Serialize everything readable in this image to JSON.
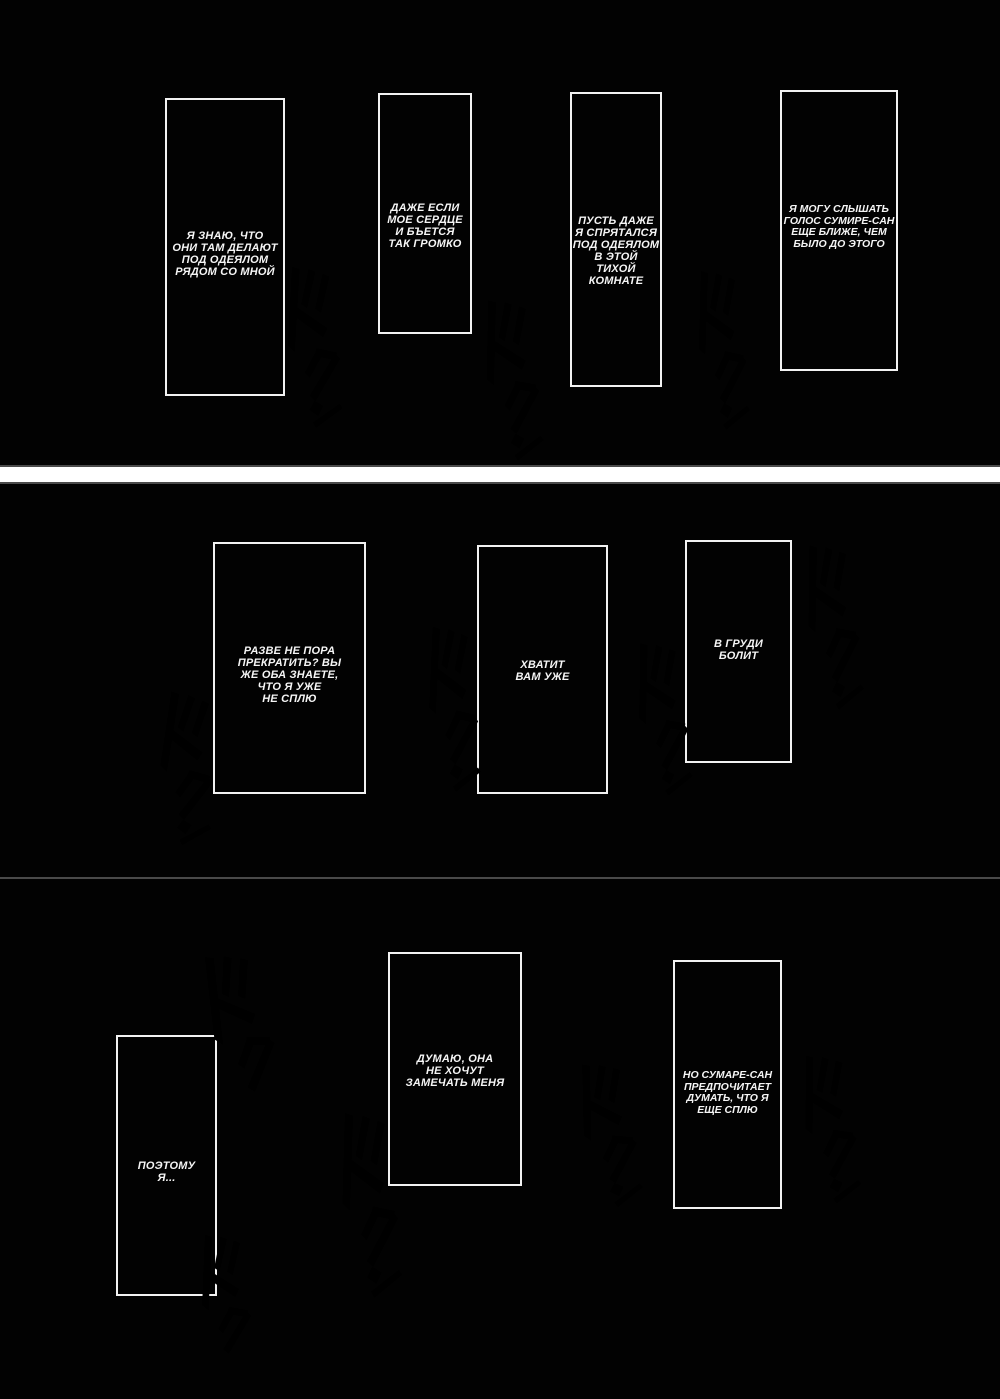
{
  "page": {
    "kind": "manga page (Russian translation)",
    "bg_color": "#ffffff",
    "strip_color": "#020202",
    "line_color": "#f2f2f2"
  },
  "strips": [
    {
      "panels": [
        {
          "text": "Я ЗНАЮ, ЧТО\nОНИ ТАМ ДЕЛАЮТ\nПОД ОДЕЯЛОМ\nРЯДОМ СО МНОЙ"
        },
        {
          "text": "ДАЖЕ ЕСЛИ\nМОЕ СЕРДЦЕ\nИ БЪЕТСЯ\nТАК ГРОМКО"
        },
        {
          "text": "ПУСТЬ ДАЖЕ\nЯ СПРЯТАЛСЯ\nПОД ОДЕЯЛОМ\nВ ЭТОЙ\nТИХОЙ\nКОМНАТЕ"
        },
        {
          "text": "Я МОГУ СЛЫШАТЬ\nГОЛОС СУМИРЕ-САН\nЕЩЕ БЛИЖЕ, ЧЕМ\nБЫЛО ДО ЭТОГО"
        }
      ]
    },
    {
      "panels": [
        {
          "text": "РАЗВЕ НЕ ПОРА\nПРЕКРАТИТЬ? ВЫ\nЖЕ ОБА ЗНАЕТЕ,\nЧТО Я УЖЕ\nНЕ СПЛЮ"
        },
        {
          "text": "ХВАТИТ\nВАМ УЖЕ"
        },
        {
          "text": "В ГРУДИ\nБОЛИТ"
        }
      ]
    },
    {
      "panels": [
        {
          "text": "ПОЭТОМУ\nЯ..."
        },
        {
          "text": "ДУМАЮ, ОНА\nНЕ ХОЧУТ\nЗАМЕЧАТЬ МЕНЯ"
        },
        {
          "text": "НО СУМАРЕ-САН\nПРЕДПОЧИТАЕТ\nДУМАТЬ, ЧТО Я\nЕЩЕ СПЛЮ"
        }
      ]
    }
  ],
  "sfx": {
    "glyphs": "ドクン",
    "name": "dokun heartbeat sound effect"
  }
}
